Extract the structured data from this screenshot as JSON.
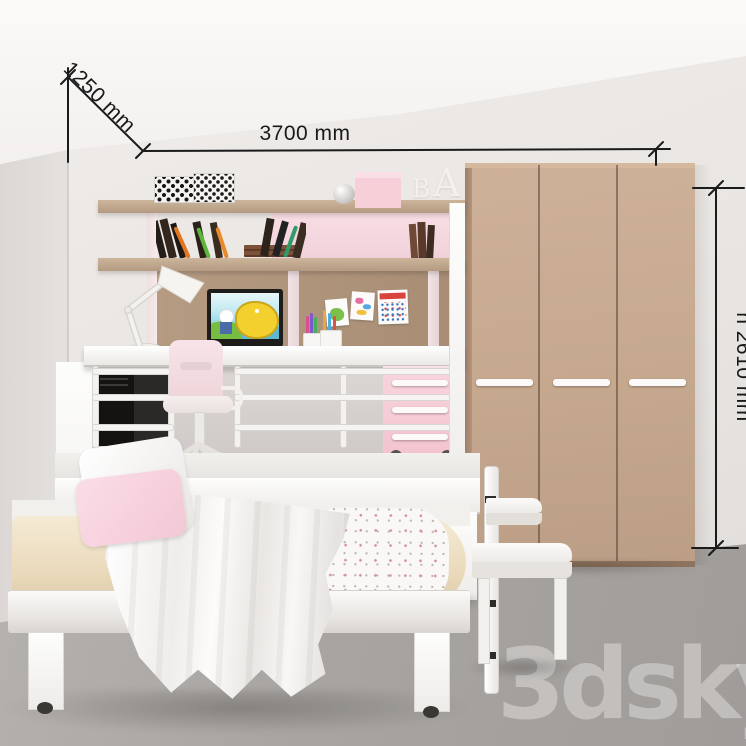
{
  "annotations": {
    "width_label": "3700 mm",
    "depth_label": "1250 mm",
    "height_label": "h 2610 mm"
  },
  "watermark": {
    "text": "3dsky"
  },
  "shelf_decor": {
    "letter_b": "B",
    "letter_a": "A"
  },
  "colors": {
    "wall": "#e8e4e1",
    "ceiling": "#f8f6f5",
    "floor": "#a8a4a1",
    "wardrobe": "#c4a78e",
    "shelf_wood": "#bda183",
    "back_panel": "#b1977e",
    "pink_accent": "#f6d3dc",
    "white_furniture": "#f4f2f0",
    "mattress_cream": "#eee2c8",
    "dimension_lines": "#1b1b1b"
  }
}
